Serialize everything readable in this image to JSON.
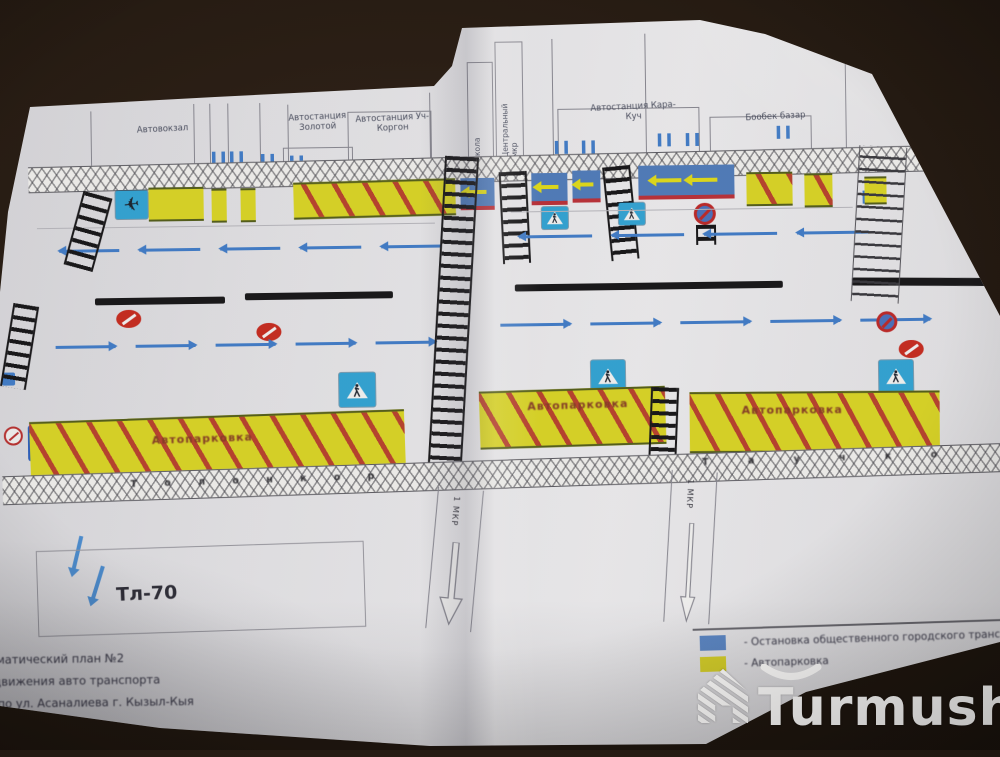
{
  "watermark": {
    "brand": "Turmush"
  },
  "legend": {
    "items": [
      {
        "swatch_color": "#5b8bd0",
        "label": "-  Остановка общественного городского транспорта"
      },
      {
        "swatch_color": "#dfd91f",
        "label": "-  Автопарковка"
      }
    ]
  },
  "plan": {
    "buildings": [
      {
        "label": "Автовокзал"
      },
      {
        "label": "Автостанция Золотой"
      },
      {
        "label": "Автостанция Уч-Коргон"
      },
      {
        "label": "Школа"
      },
      {
        "label": "Центральный мкр"
      },
      {
        "label": "Автостанция Кара-Куч"
      },
      {
        "label": "Бообек базар"
      }
    ],
    "parking_label_left": "Автопарковка",
    "parking_label_mid": "Автопарковка",
    "parking_label_right": "Автопарковка",
    "street_name_left": "Т о л о н к о р",
    "street_name_right": "Т а у ч к о",
    "block_label": "Тл-70",
    "side_road_label_left": "1 МКР",
    "side_road_label_right": "1 МКР",
    "parking_sign": "P",
    "airplane_glyph": "✈",
    "caption_lines": [
      "ематический план №2",
      "движения авто транспорта",
      "по ул. Асаналиева г. Кызыл-Кыя"
    ]
  }
}
